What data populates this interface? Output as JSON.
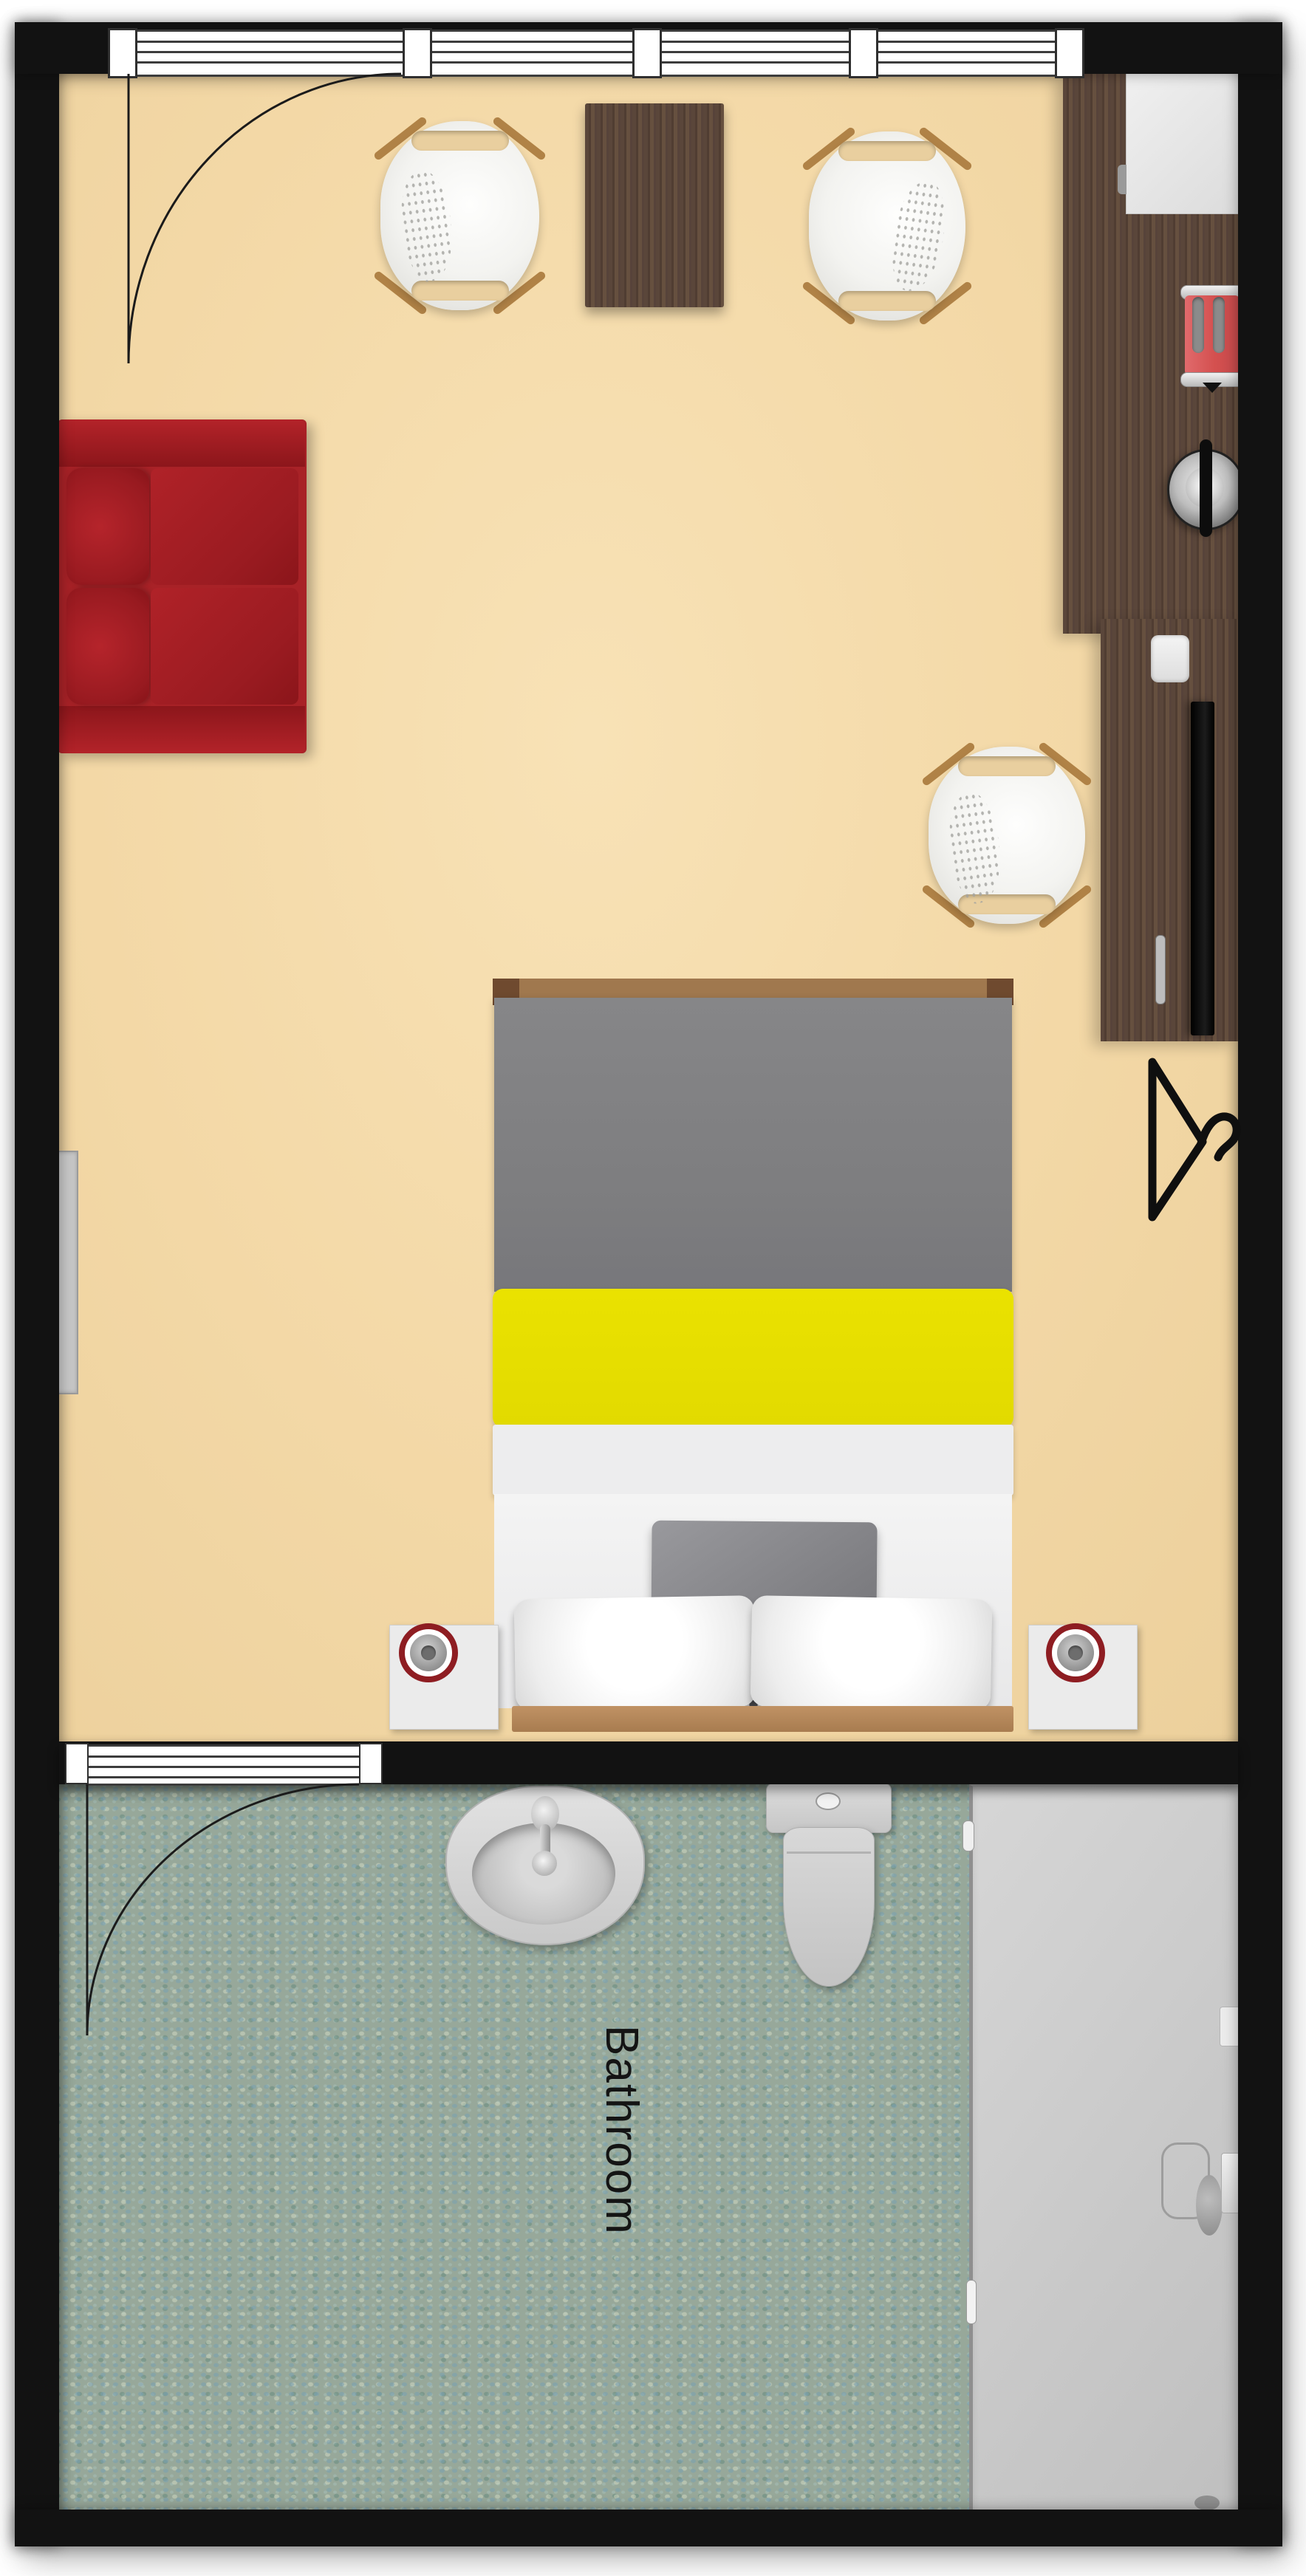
{
  "document": {
    "type": "floor-plan",
    "view": "top-down 2D rendering of a hotel room with bathroom"
  },
  "labels": {
    "bathroom": "Bathroom"
  },
  "rooms": [
    {
      "name": "bedroom-living-area",
      "floor": "beige"
    },
    {
      "name": "bathroom",
      "label": "Bathroom",
      "floor": "teal mosaic tile"
    }
  ],
  "furniture": [
    "entry-door",
    "window-band",
    "armchair-top-left",
    "square-side-table",
    "armchair-top-right",
    "wall-counter",
    "mini-fridge",
    "toaster",
    "kettle",
    "desk",
    "tv",
    "desk-chair",
    "red-sofa",
    "radiator",
    "double-bed",
    "gray-duvet",
    "yellow-runner",
    "throw-pillow",
    "nightstand-left",
    "nightstand-right",
    "bedside-lamp-left",
    "bedside-lamp-right",
    "clothes-hanger",
    "bathroom-door",
    "sink",
    "toilet",
    "shower-enclosure"
  ],
  "colors": {
    "wall": "#121212",
    "floor-bedroom": "#f3d8a6",
    "floor-bedroom-light": "#f8e2b6",
    "floor-bathroom": "#97a89a",
    "wood-counter": "#5a463a",
    "wood-light": "#b08246",
    "sofa-red": "#a82227",
    "bed-gray": "#7f7f81",
    "bed-yellow": "#eae200",
    "accent-red-ring": "#8e1d22",
    "toaster-red": "#d4504f",
    "shower-gray": "#c9c9c9",
    "text": "#141414"
  }
}
